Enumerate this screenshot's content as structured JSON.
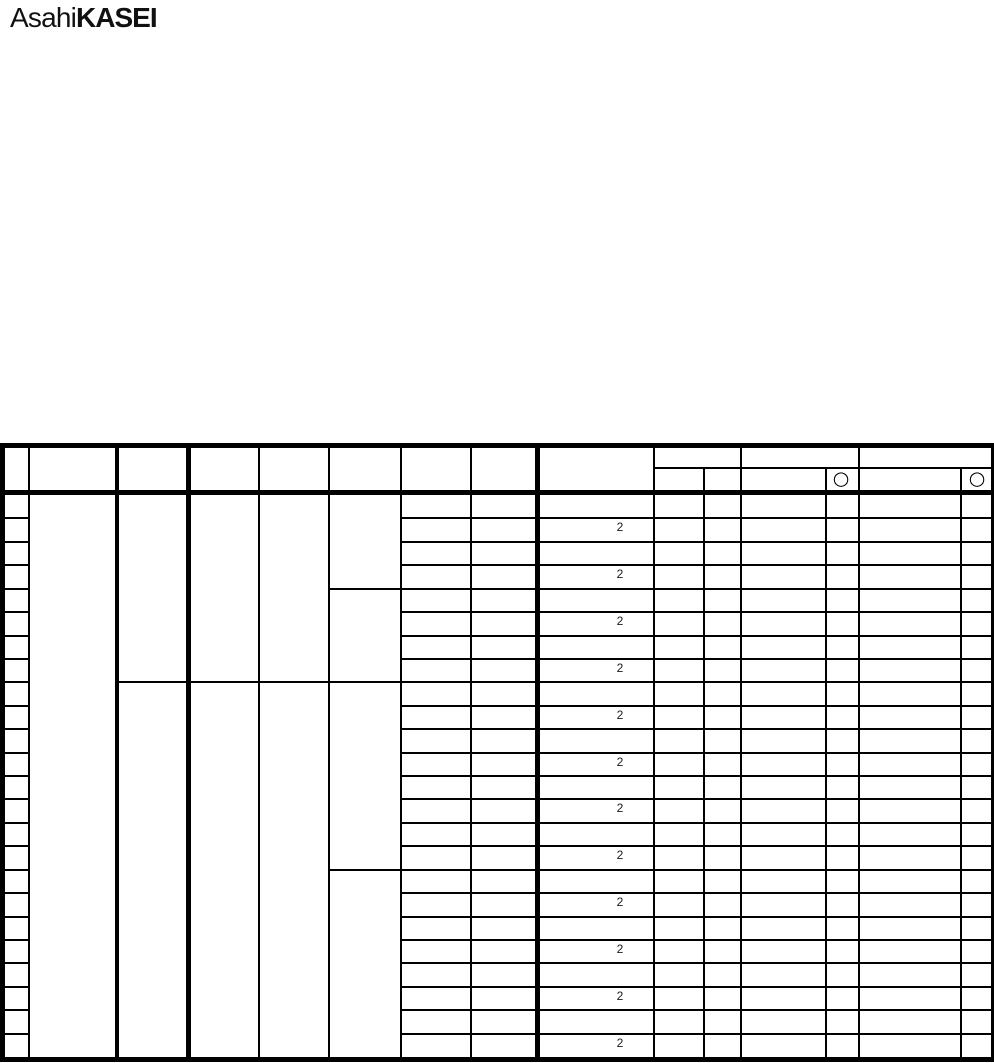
{
  "logo": {
    "brand_regular": "Asahi",
    "brand_bold": "KASEI",
    "color": "#111111"
  },
  "table": {
    "line_color": "#000000",
    "header": {
      "circle_marks": [
        {
          "column": 13,
          "symbol": "○"
        },
        {
          "column": 15,
          "symbol": "○"
        }
      ]
    },
    "body": {
      "row_count": 24,
      "quantity_marks": [
        {
          "row": 2,
          "text": "2"
        },
        {
          "row": 4,
          "text": "2"
        },
        {
          "row": 6,
          "text": "2"
        },
        {
          "row": 8,
          "text": "2"
        },
        {
          "row": 10,
          "text": "2"
        },
        {
          "row": 12,
          "text": "2"
        },
        {
          "row": 14,
          "text": "2"
        },
        {
          "row": 16,
          "text": "2"
        },
        {
          "row": 18,
          "text": "2"
        },
        {
          "row": 20,
          "text": "2"
        },
        {
          "row": 22,
          "text": "2"
        },
        {
          "row": 24,
          "text": "2"
        }
      ]
    }
  }
}
